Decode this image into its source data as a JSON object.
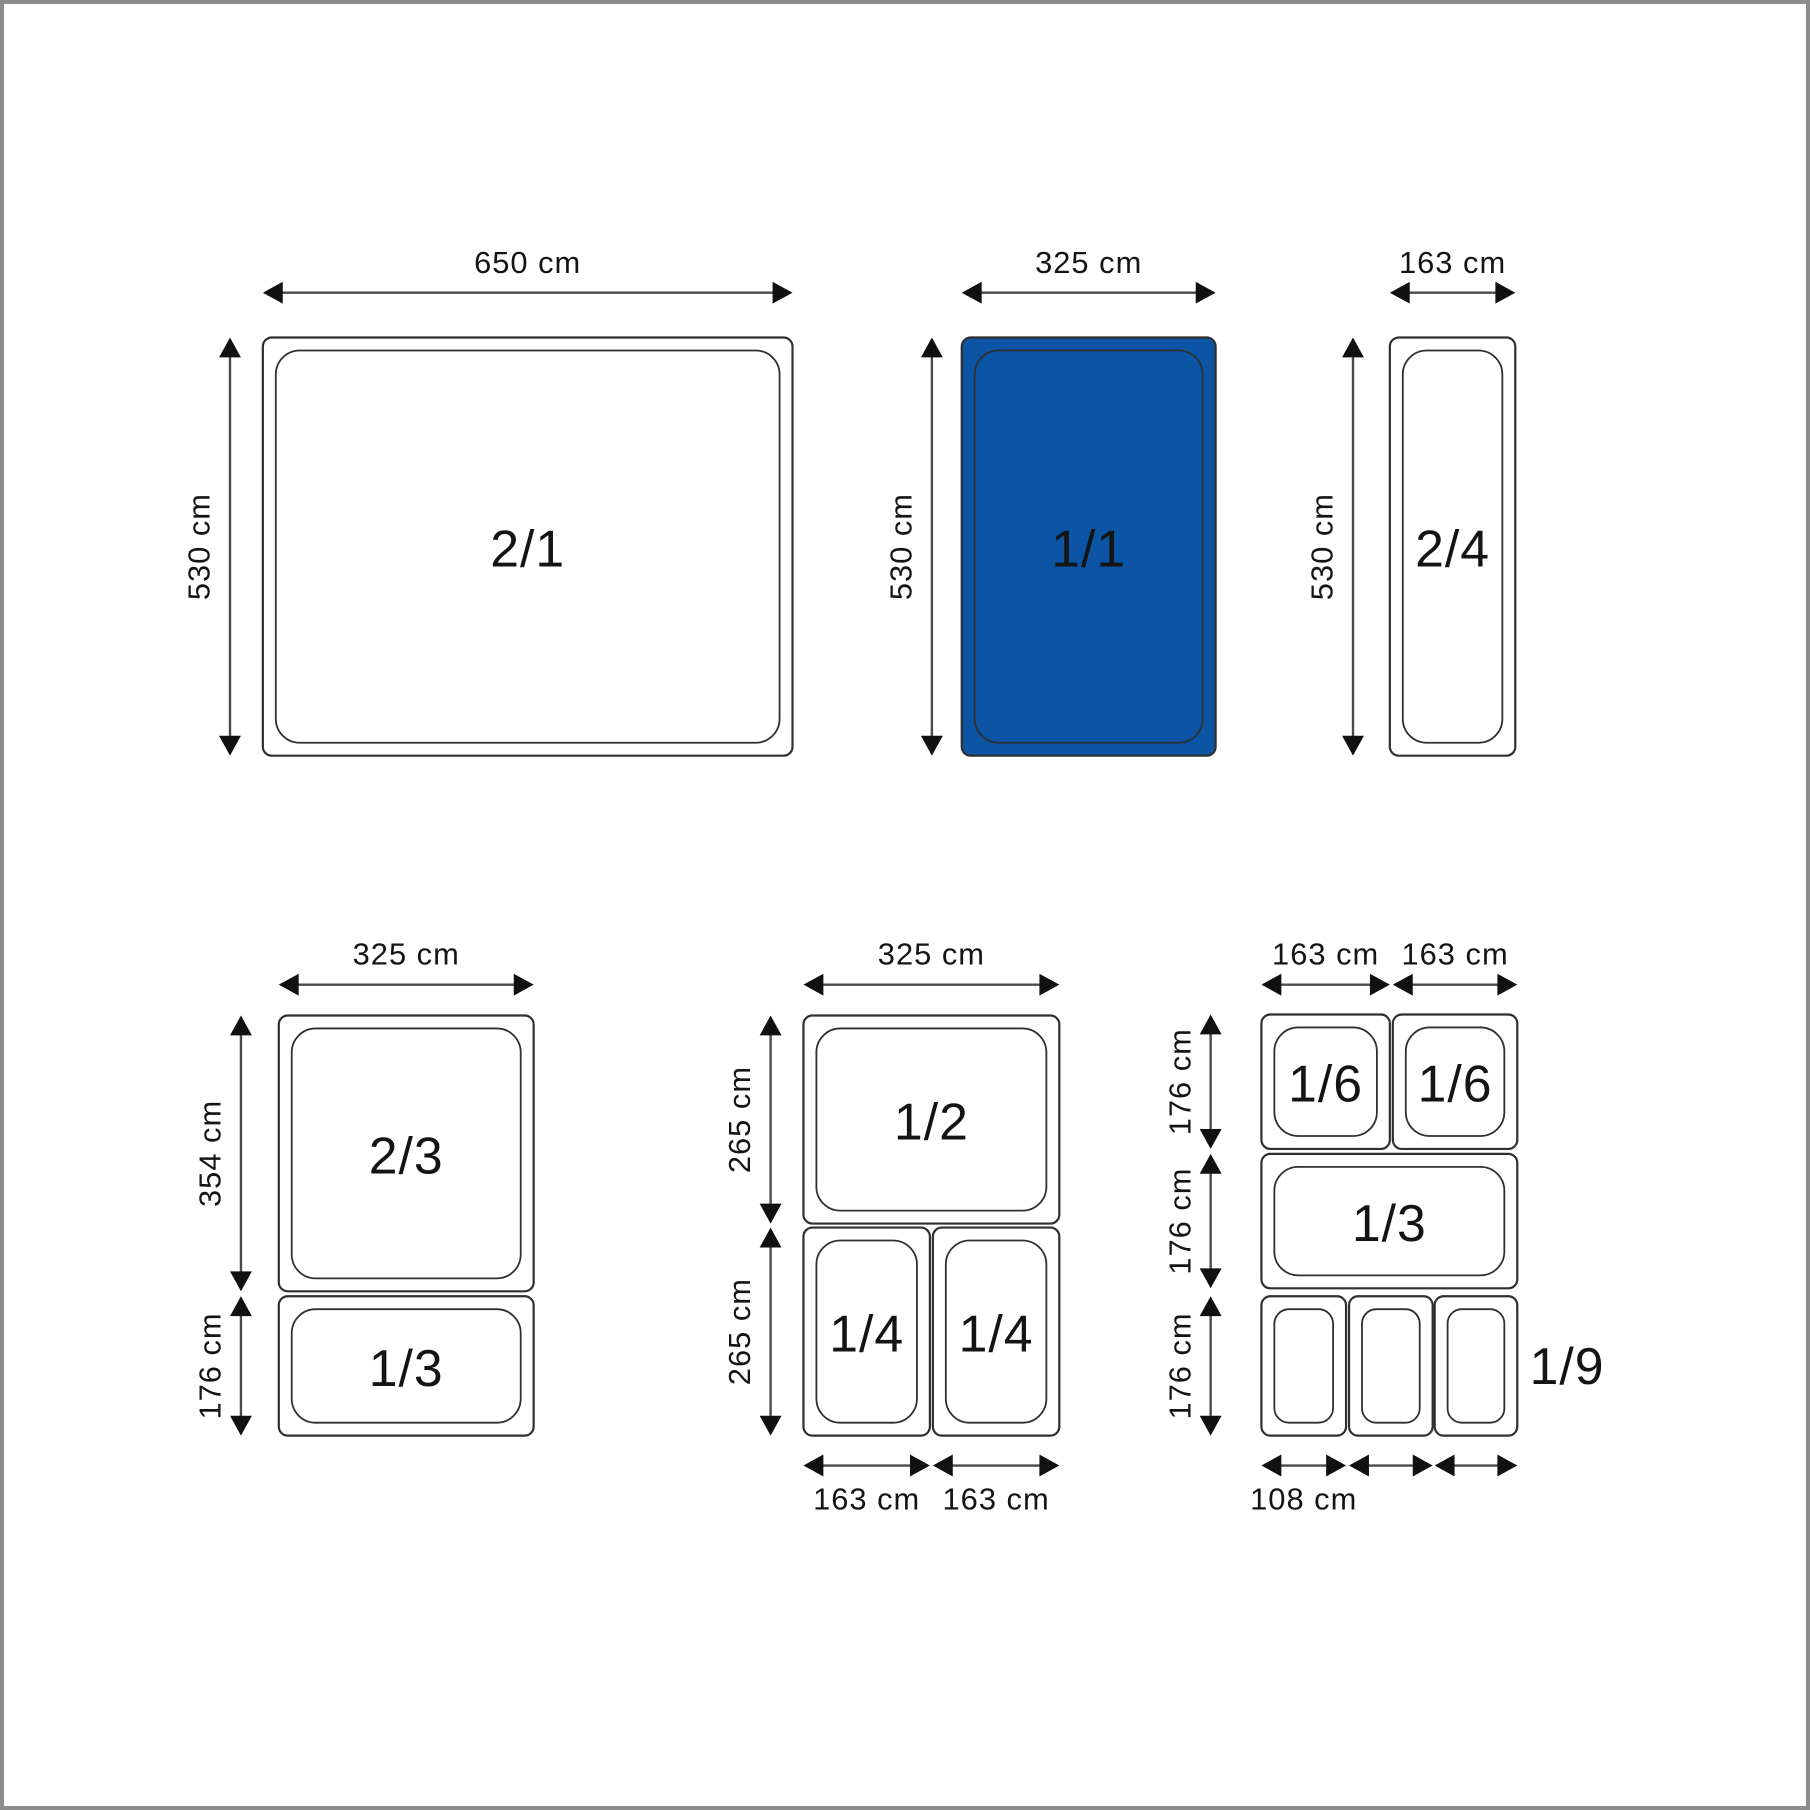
{
  "title": "Gastronorm pan sizes diagram",
  "colors": {
    "background": "#ffffff",
    "frame_border": "#8c8c8c",
    "pan_stroke": "#2f2f2f",
    "pan_fill": "#ffffff",
    "highlight_fill": "#0b55a4",
    "arrow_line": "#4a4a4a",
    "arrow_head": "#111111",
    "text": "#141414"
  },
  "diagram": {
    "width": 1810,
    "height": 1810,
    "pans": [
      {
        "name": "pan-2-1",
        "fraction": "2/1",
        "x": 260,
        "y": 335,
        "w": 532,
        "h": 420,
        "highlighted": false
      },
      {
        "name": "pan-1-1",
        "fraction": "1/1",
        "x": 962,
        "y": 335,
        "w": 255,
        "h": 420,
        "highlighted": true
      },
      {
        "name": "pan-2-4",
        "fraction": "2/4",
        "x": 1392,
        "y": 335,
        "w": 126,
        "h": 420,
        "highlighted": false
      },
      {
        "name": "pan-2-3",
        "fraction": "2/3",
        "x": 276,
        "y": 1016,
        "w": 256,
        "h": 277,
        "highlighted": false
      },
      {
        "name": "pan-1-3-left",
        "fraction": "1/3",
        "x": 276,
        "y": 1298,
        "w": 256,
        "h": 140,
        "highlighted": false
      },
      {
        "name": "pan-1-2",
        "fraction": "1/2",
        "x": 803,
        "y": 1016,
        "w": 257,
        "h": 209,
        "highlighted": false
      },
      {
        "name": "pan-1-4-a",
        "fraction": "1/4",
        "x": 803,
        "y": 1229,
        "w": 127,
        "h": 209,
        "highlighted": false
      },
      {
        "name": "pan-1-4-b",
        "fraction": "1/4",
        "x": 933,
        "y": 1229,
        "w": 127,
        "h": 209,
        "highlighted": false
      },
      {
        "name": "pan-1-6-a",
        "fraction": "1/6",
        "x": 1263,
        "y": 1015,
        "w": 129,
        "h": 135,
        "highlighted": false
      },
      {
        "name": "pan-1-6-b",
        "fraction": "1/6",
        "x": 1395,
        "y": 1015,
        "w": 125,
        "h": 135,
        "highlighted": false
      },
      {
        "name": "pan-1-3-right",
        "fraction": "1/3",
        "x": 1263,
        "y": 1155,
        "w": 257,
        "h": 135,
        "highlighted": false
      },
      {
        "name": "pan-1-9-a",
        "fraction": "",
        "x": 1263,
        "y": 1298,
        "w": 85,
        "h": 140,
        "highlighted": false
      },
      {
        "name": "pan-1-9-b",
        "fraction": "",
        "x": 1351,
        "y": 1298,
        "w": 84,
        "h": 140,
        "highlighted": false
      },
      {
        "name": "pan-1-9-c",
        "fraction": "",
        "x": 1437,
        "y": 1298,
        "w": 83,
        "h": 140,
        "highlighted": false
      }
    ],
    "floating_labels": [
      {
        "name": "label-1-9",
        "text": "1/9",
        "x": 1570,
        "y": 1368
      }
    ],
    "h_dims": [
      {
        "name": "dim-650-top",
        "label": "650 cm",
        "x1": 260,
        "x2": 792,
        "y": 290,
        "label_pos": "above"
      },
      {
        "name": "dim-325-top",
        "label": "325 cm",
        "x1": 962,
        "x2": 1217,
        "y": 290,
        "label_pos": "above"
      },
      {
        "name": "dim-163-top",
        "label": "163 cm",
        "x1": 1392,
        "x2": 1518,
        "y": 290,
        "label_pos": "above"
      },
      {
        "name": "dim-325-left-group",
        "label": "325 cm",
        "x1": 276,
        "x2": 532,
        "y": 985,
        "label_pos": "above"
      },
      {
        "name": "dim-325-mid-group",
        "label": "325 cm",
        "x1": 803,
        "x2": 1060,
        "y": 985,
        "label_pos": "above"
      },
      {
        "name": "dim-163-right-a",
        "label": "163 cm",
        "x1": 1263,
        "x2": 1392,
        "y": 985,
        "label_pos": "above"
      },
      {
        "name": "dim-163-right-b",
        "label": "163 cm",
        "x1": 1395,
        "x2": 1520,
        "y": 985,
        "label_pos": "above"
      },
      {
        "name": "dim-163-bottom-a",
        "label": "163 cm",
        "x1": 803,
        "x2": 930,
        "y": 1468,
        "label_pos": "below"
      },
      {
        "name": "dim-163-bottom-b",
        "label": "163 cm",
        "x1": 933,
        "x2": 1060,
        "y": 1468,
        "label_pos": "below"
      },
      {
        "name": "dim-108-bottom-a",
        "label": "108 cm",
        "x1": 1263,
        "x2": 1348,
        "y": 1468,
        "label_pos": "below"
      },
      {
        "name": "dim-108-bottom-b",
        "label": "",
        "x1": 1351,
        "x2": 1435,
        "y": 1468,
        "label_pos": "below"
      },
      {
        "name": "dim-108-bottom-c",
        "label": "",
        "x1": 1437,
        "x2": 1520,
        "y": 1468,
        "label_pos": "below"
      }
    ],
    "v_dims": [
      {
        "name": "dim-530-a",
        "label": "530 cm",
        "y1": 335,
        "y2": 755,
        "x": 227
      },
      {
        "name": "dim-530-b",
        "label": "530 cm",
        "y1": 335,
        "y2": 755,
        "x": 932
      },
      {
        "name": "dim-530-c",
        "label": "530 cm",
        "y1": 335,
        "y2": 755,
        "x": 1355
      },
      {
        "name": "dim-354",
        "label": "354 cm",
        "y1": 1016,
        "y2": 1293,
        "x": 238
      },
      {
        "name": "dim-176-left",
        "label": "176 cm",
        "y1": 1298,
        "y2": 1438,
        "x": 238
      },
      {
        "name": "dim-265-a",
        "label": "265 cm",
        "y1": 1016,
        "y2": 1225,
        "x": 770
      },
      {
        "name": "dim-265-b",
        "label": "265 cm",
        "y1": 1229,
        "y2": 1438,
        "x": 770
      },
      {
        "name": "dim-176-right-a",
        "label": "176 cm",
        "y1": 1015,
        "y2": 1150,
        "x": 1212
      },
      {
        "name": "dim-176-right-b",
        "label": "176 cm",
        "y1": 1155,
        "y2": 1290,
        "x": 1212
      },
      {
        "name": "dim-176-right-c",
        "label": "176 cm",
        "y1": 1298,
        "y2": 1438,
        "x": 1212
      }
    ]
  }
}
